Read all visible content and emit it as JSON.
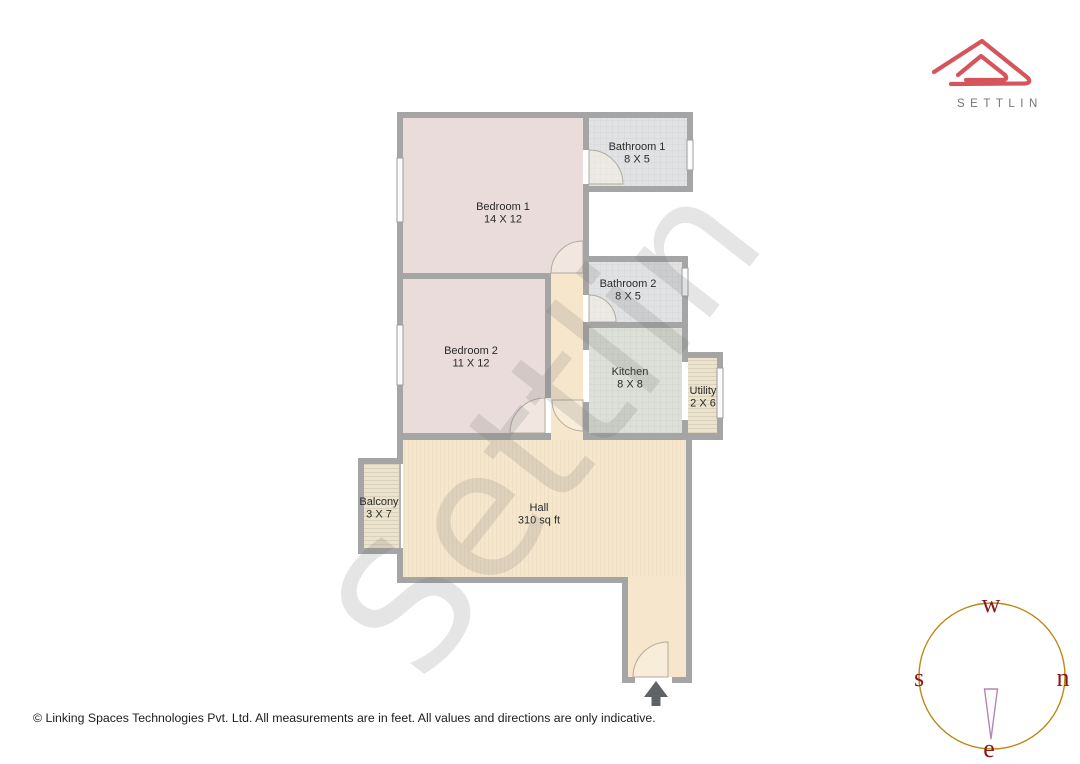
{
  "header": {
    "logo_brand": "SETTLIN"
  },
  "floorplan": {
    "watermark": "Settlin",
    "rooms": [
      {
        "name": "Bedroom 1",
        "dims": "14 X 12"
      },
      {
        "name": "Bathroom 1",
        "dims": "8 X 5"
      },
      {
        "name": "Bathroom 2",
        "dims": "8 X 5"
      },
      {
        "name": "Bedroom 2",
        "dims": "11 X 12"
      },
      {
        "name": "Kitchen",
        "dims": "8 X 8"
      },
      {
        "name": "Utility",
        "dims": "2 X 6"
      },
      {
        "name": "Balcony",
        "dims": "3 X 7"
      },
      {
        "name": "Hall",
        "dims": "310 sq ft"
      }
    ]
  },
  "compass": {
    "top": "w",
    "left": "s",
    "right": "n",
    "bottom": "e"
  },
  "footer": {
    "copyright": "© Linking Spaces Technologies Pvt. Ltd. All measurements are in feet. All values and directions are only indicative."
  },
  "colors": {
    "brand_red": "#d6555c",
    "brand_text_gray": "#757575",
    "wall_gray": "#a5a5a5",
    "bedroom_fill": "#e9dcdb",
    "bathroom_fill": "#e1e2e4",
    "kitchen_fill": "#dde0d8",
    "utility_balcony_fill": "#ebe3cb",
    "hall_fill": "#f6e7cc",
    "compass_ring_gold": "#bb8a12",
    "compass_letter_red": "#8b1717",
    "entrance_arrow_gray": "#5f6368"
  }
}
